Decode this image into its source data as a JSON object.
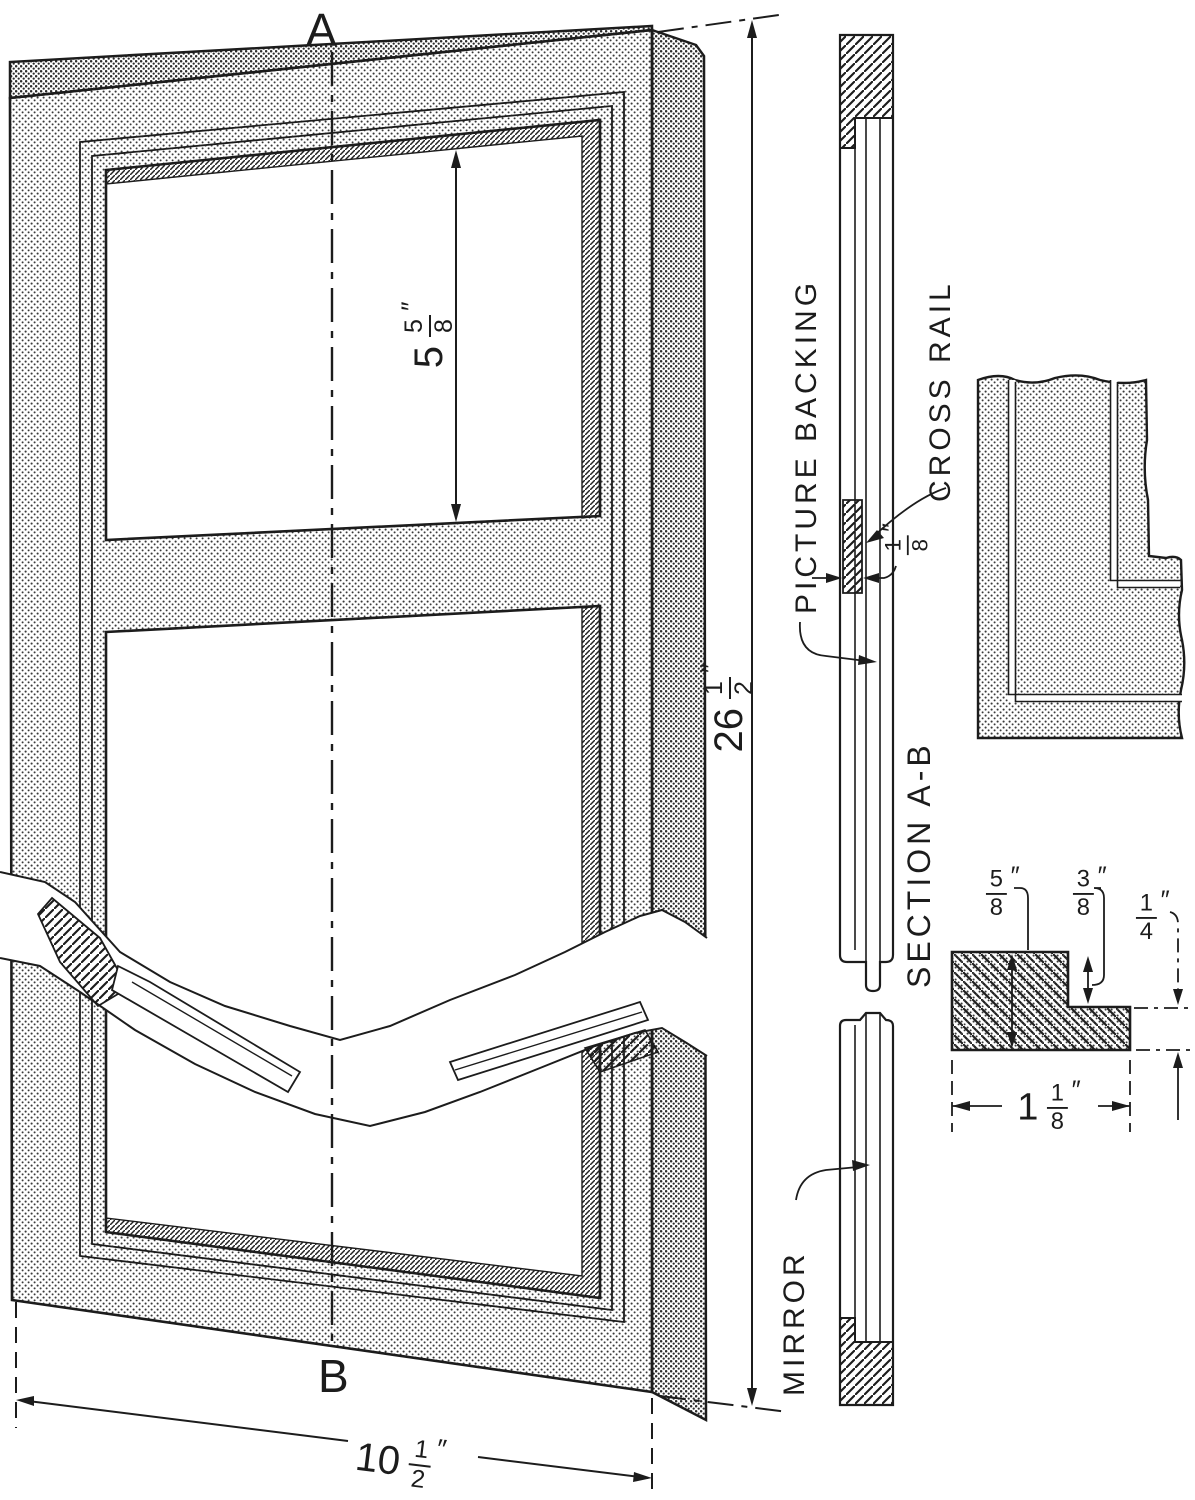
{
  "page": {
    "background": "#ffffff",
    "ink_color": "#1c1c1c"
  },
  "main_view": {
    "section_cut_label_top": "A",
    "section_cut_label_bottom": "B",
    "dim_opening_height": {
      "whole": "5",
      "num": "5",
      "den": "8",
      "unit": "″"
    },
    "dim_frame_height": {
      "whole": "26",
      "num": "1",
      "den": "2",
      "unit": "″"
    },
    "dim_frame_width": {
      "whole": "10",
      "num": "1",
      "den": "2",
      "unit": "″"
    }
  },
  "section_view": {
    "title": "SECTION A-B",
    "picture_backing_label": "PICTURE BACKING",
    "cross_rail_label": "CROSS RAIL",
    "mirror_label": "MIRROR",
    "dim_cross_rail_thickness": {
      "whole": "",
      "num": "1",
      "den": "8",
      "unit": "″"
    }
  },
  "profile_detail": {
    "dim_face_thickness": {
      "whole": "",
      "num": "5",
      "den": "8",
      "unit": "″"
    },
    "dim_rabbet_width": {
      "whole": "",
      "num": "3",
      "den": "8",
      "unit": "″"
    },
    "dim_rabbet_depth": {
      "whole": "",
      "num": "1",
      "den": "4",
      "unit": "″"
    },
    "dim_overall_width": {
      "whole": "1",
      "num": "1",
      "den": "8",
      "unit": "″"
    }
  }
}
